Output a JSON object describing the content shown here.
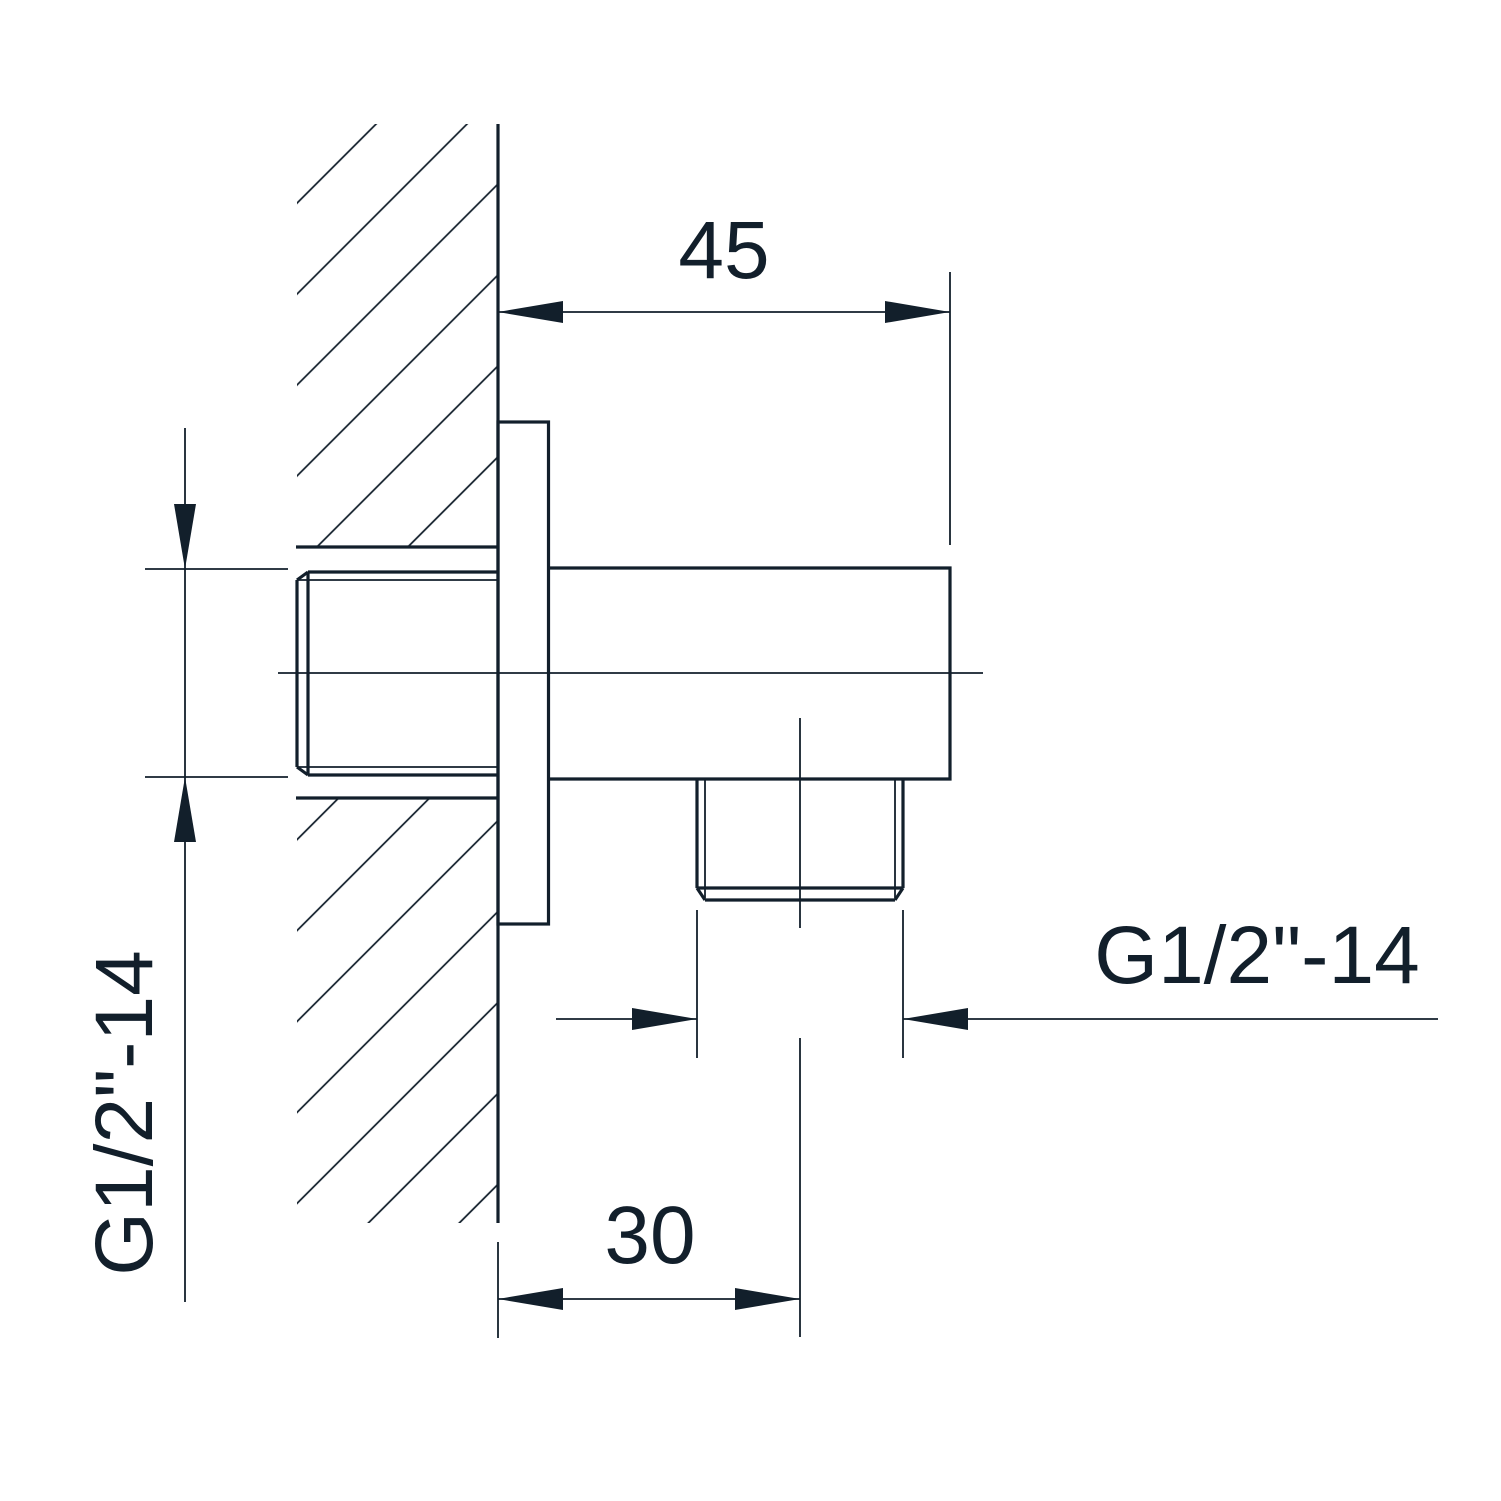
{
  "colors": {
    "ink": "#121f2b",
    "paper": "#ffffff"
  },
  "dimensions": {
    "top_width": "45",
    "outlet_offset": "30",
    "inlet_thread": "G1/2\"-14",
    "outlet_thread": "G1/2\"-14"
  }
}
